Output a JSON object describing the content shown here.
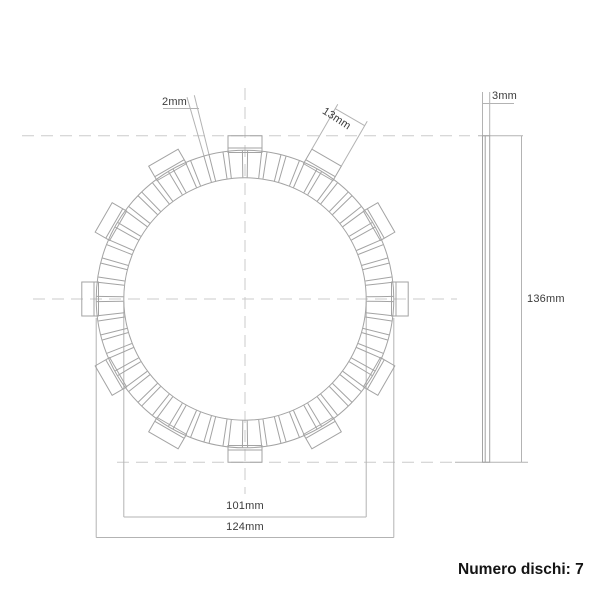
{
  "labels": {
    "groove_width": "2mm",
    "tab_width": "13mm",
    "thickness": "3mm",
    "overall_diameter": "136mm",
    "inner_diameter": "101mm",
    "outer_diameter": "124mm",
    "disc_count_note": "Numero dischi: 7"
  },
  "drawing": {
    "type": "technical-drawing-clutch-friction-plate",
    "center": {
      "x": 245,
      "y": 299
    },
    "scale_px_per_mm": 2.4,
    "values_mm": {
      "inner_diameter": 101,
      "outer_diameter": 124,
      "overall_diameter": 136,
      "thickness": 3,
      "tab_width": 13,
      "groove_width": 2
    },
    "tab_count": 12,
    "groove_count": 48,
    "colors": {
      "background": "#ffffff",
      "outline": "#a3a3a3",
      "centerline": "#cbcbcb",
      "dimension": "#b3b3b3",
      "label_text": "#3c3c3c",
      "note_text": "#141414"
    }
  }
}
